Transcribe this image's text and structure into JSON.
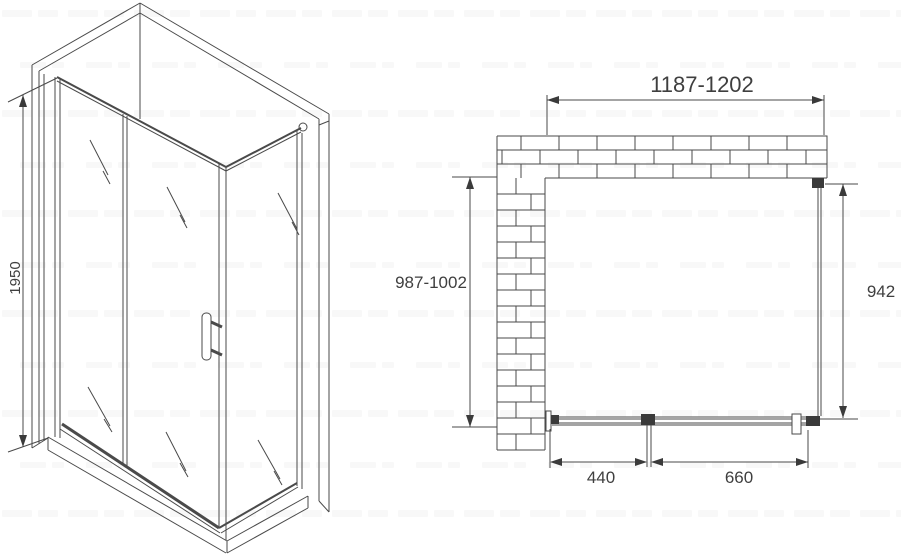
{
  "iso_view": {
    "height_dim": "1950"
  },
  "plan_view": {
    "width_dim": "1187-1202",
    "depth_dim": "987-1002",
    "side_glass_dim": "942",
    "door_dim": "440",
    "fixed_panel_dim": "660"
  },
  "colors": {
    "line": "#4a4a4a",
    "dark_fill": "#3a3a3a",
    "background": "#ffffff"
  }
}
